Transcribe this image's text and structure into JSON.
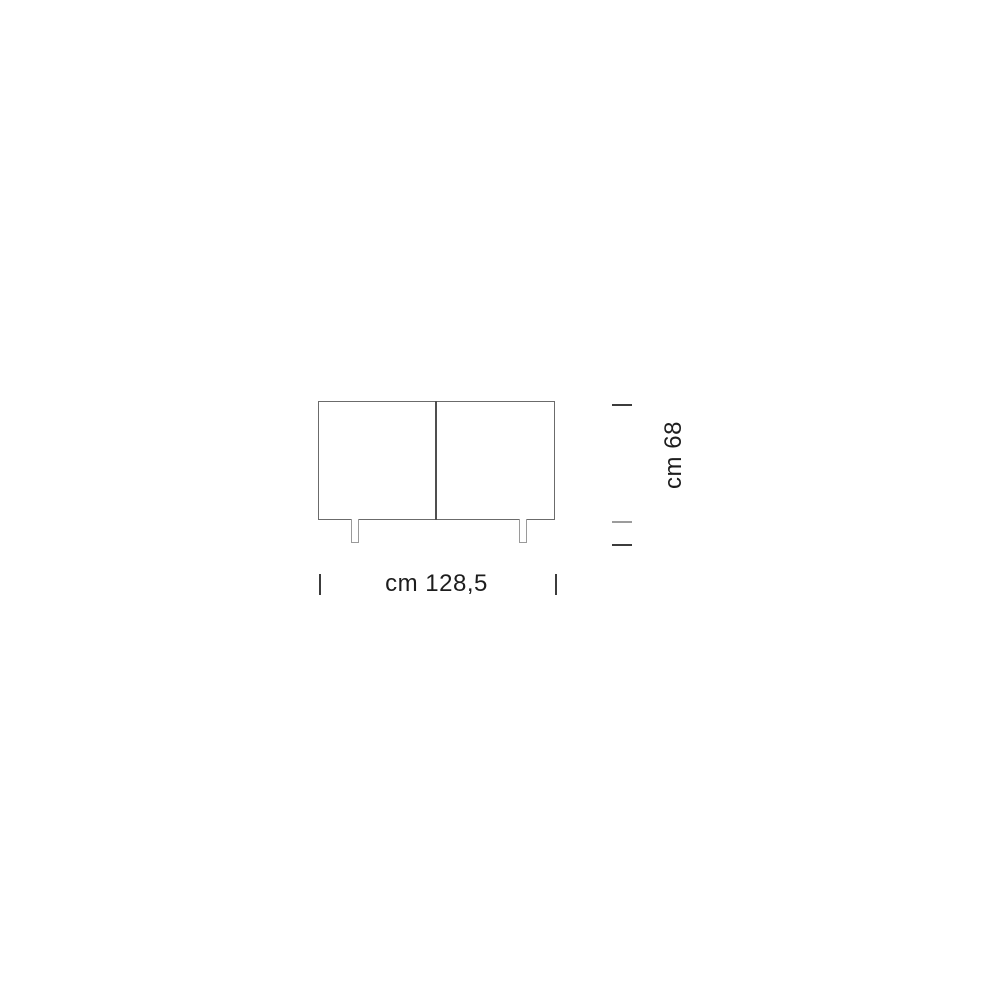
{
  "diagram": {
    "width_label": "cm 128,5",
    "height_label": "cm 68",
    "colors": {
      "background": "#ffffff",
      "outline": "#6b6b6b",
      "divider": "#4f4f4f",
      "leg_outline": "#9a9a9a",
      "tick_dark": "#3c3c3c",
      "tick_light": "#9c9c9c",
      "text": "#1d1d1d"
    }
  }
}
